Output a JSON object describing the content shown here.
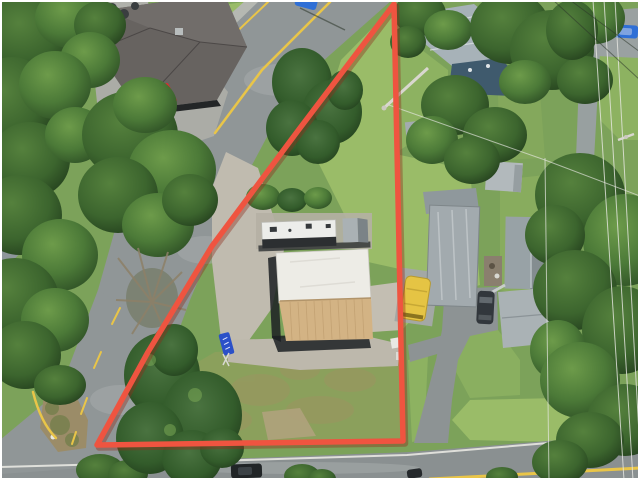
{
  "scene": {
    "type": "aerial-drone-photograph",
    "subject": "commercial lot outlined with red property boundary, surrounded by roads, houses and trees"
  },
  "boundary": {
    "outline_points": "394,4 300,128 212,246 148,352 97,445 403,441",
    "stroke_width": "5.5"
  },
  "palette": {
    "frame_white": "#ffffff",
    "grass_base": "#7ca25a",
    "grass_sunny": "#9abc68",
    "grass_mid": "#8db261",
    "road_asphalt": "#909697",
    "road_asphalt_dark": "#8a9091",
    "gravel_light": "#c0bbaf",
    "dirt_brush": "#9b8c68",
    "roof_restaurant": "#676360",
    "roof_metal_blue": "#a7b2b8",
    "roof_house_dark_blue": "#3f5a6d",
    "roof_mobile_gray": "#a2aaae",
    "roof_building_white": "#edece6",
    "roof_building_tan": "#d3b384",
    "trailer_white": "#ecedea",
    "shadow_dark": "#1c2023",
    "line_yellow": "#e9c548",
    "line_white": "#e8e8e2",
    "bus_yellow": "#e5c444",
    "car_red": "#cc2626",
    "car_blue": "#2f6fd6",
    "car_dark": "#32373c",
    "sign_blue": "#2b50c8",
    "boundary_red": "#ef5440",
    "boundary_shadow": "#8e2d1c"
  }
}
